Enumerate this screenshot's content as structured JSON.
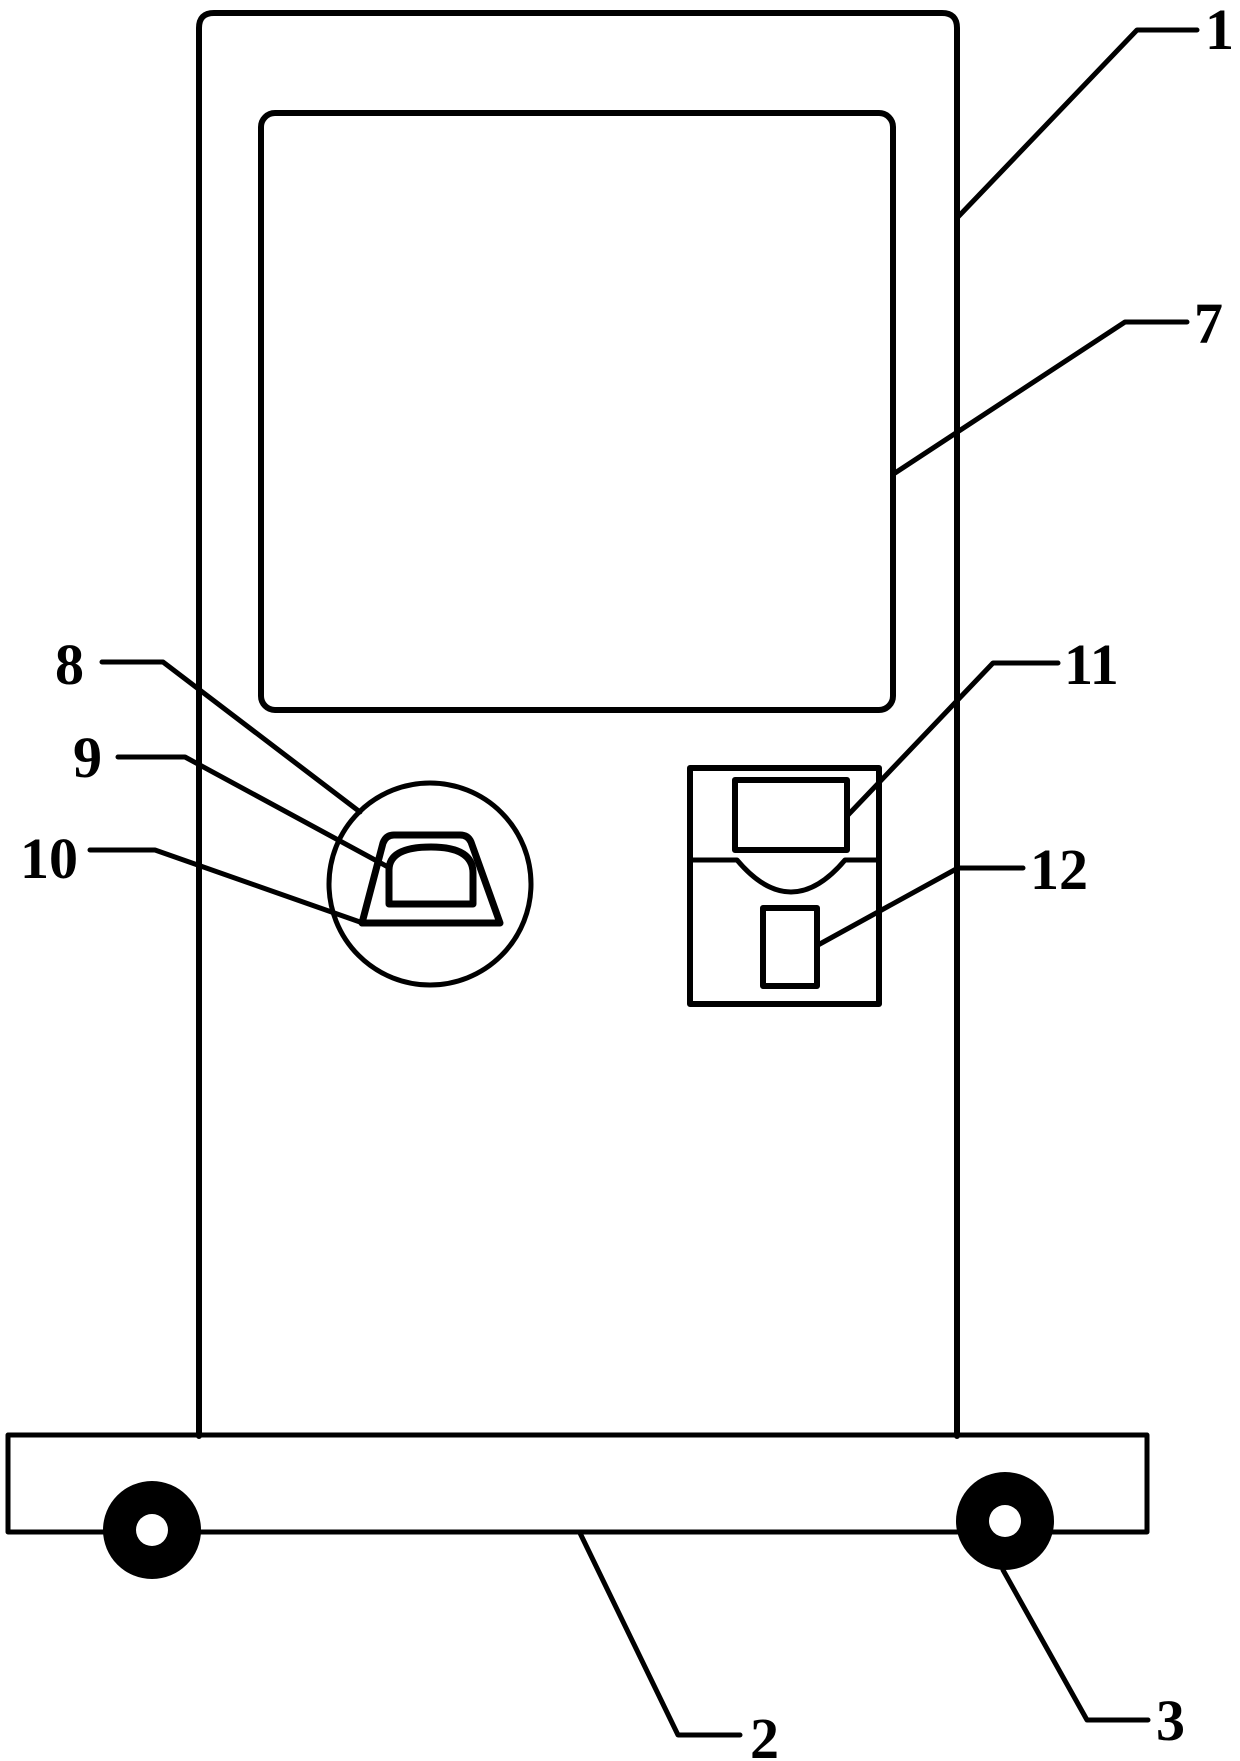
{
  "figure": {
    "kind": "patent-line-drawing",
    "colors": {
      "line": "#000000",
      "background": "#ffffff",
      "wheel_fill": "#000000"
    },
    "callouts": {
      "cabinet": "1",
      "screen": "7",
      "scanner_ring": "8",
      "scanner_hood": "9",
      "scanner_dome": "10",
      "card_reader": "11",
      "slot": "12",
      "base": "2",
      "wheel": "3"
    }
  }
}
